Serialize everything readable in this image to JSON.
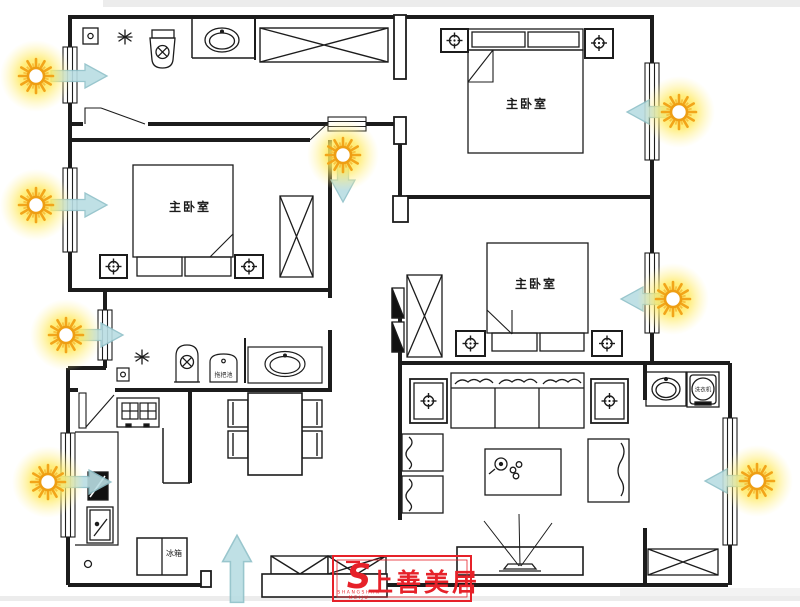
{
  "document": {
    "type": "residential floor plan with daylight analysis arrows"
  },
  "rooms": [
    {
      "id": "bedroom-west",
      "label": "主卧室"
    },
    {
      "id": "bedroom-northeast",
      "label": "主卧室"
    },
    {
      "id": "bedroom-east",
      "label": "主卧室"
    }
  ],
  "fixtures": {
    "mop_sink": "拖把池",
    "fridge": "冰箱",
    "washing_machine": "洗衣机"
  },
  "logo": {
    "symbol": "S",
    "brand": "上善美居",
    "caption_top": "SHANGSHAN",
    "caption_bottom": "MEIJU",
    "color": "#e62129"
  },
  "light_indicators": [
    {
      "wall": "west",
      "at": "north bathroom window",
      "direction": "east"
    },
    {
      "wall": "west",
      "at": "west bedroom window",
      "direction": "east"
    },
    {
      "wall": "west",
      "at": "central hallway window",
      "direction": "east"
    },
    {
      "wall": "west",
      "at": "kitchen window",
      "direction": "east"
    },
    {
      "wall": "north",
      "at": "corridor window",
      "direction": "south"
    },
    {
      "wall": "east",
      "at": "northeast bedroom window",
      "direction": "west"
    },
    {
      "wall": "east",
      "at": "east bedroom window",
      "direction": "west"
    },
    {
      "wall": "east",
      "at": "laundry balcony window",
      "direction": "west"
    }
  ],
  "entry": {
    "direction": "up",
    "at": "south entrance"
  },
  "icons": {
    "sun-icon": "yellow sunburst marking a daylight source",
    "light-arrow-icon": "translucent cyan arrow showing light direction",
    "entry-arrow-icon": "translucent cyan arrow marking the entrance",
    "lamp-icon": "crosshair-in-circle lamp symbol",
    "vent-icon": "asterisk drain/vent symbol",
    "burner-icon": "crossed square stove burner symbol",
    "toilet-icon": "toilet with crossed bowl",
    "washer-drum-icon": "washing machine drum circle"
  },
  "colors": {
    "wall": "#1c1c1c",
    "sun_glow": "#ffe95c",
    "sun_ray": "#f2a51a",
    "sun_core": "#ffffff",
    "arrow_fill": "#b9dde3",
    "arrow_stroke": "#8fc0c8",
    "logo_red": "#e62129",
    "band_gray": "#ececec"
  }
}
